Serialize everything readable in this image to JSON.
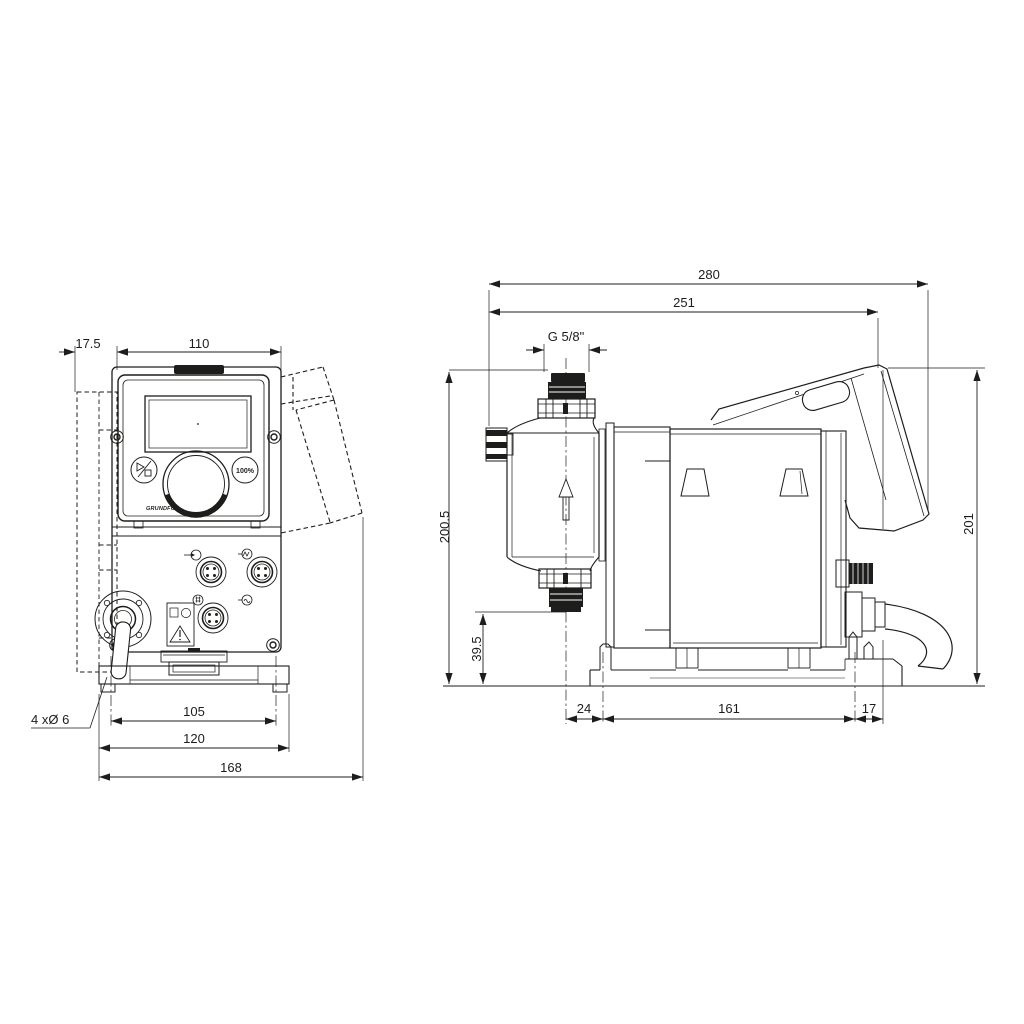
{
  "colors": {
    "background": "#ffffff",
    "line": "#1d1d1b"
  },
  "views": {
    "front": {
      "dims": {
        "bracket_offset": "17.5",
        "housing_width": "110",
        "hole_spacing": "105",
        "plate_width": "120",
        "overall_width": "168"
      },
      "mounting_holes_note": "4 xØ 6",
      "control_panel": {
        "capacity_button_label": "100%",
        "brand_logo": "GRUNDFOS"
      }
    },
    "side": {
      "dims": {
        "overall_depth": "280",
        "depth_to_control_cube": "251",
        "connection_thread": "G 5/8\"",
        "height_to_connection": "200.5",
        "suction_valve_height": "39.5",
        "head_to_plate_offset": "24",
        "plate_hole_spacing": "161",
        "plate_rear_offset": "17",
        "control_cube_height": "201"
      }
    }
  },
  "icons": {
    "start-stop-icon": "▷/□",
    "flow-direction-icon": "↑",
    "warning-icon": "⚠",
    "connector-signal-icon": "→◦",
    "connector-pulse-icon": "∿",
    "connector-grid-icon": "▤",
    "connector-wave-icon": "≀"
  }
}
